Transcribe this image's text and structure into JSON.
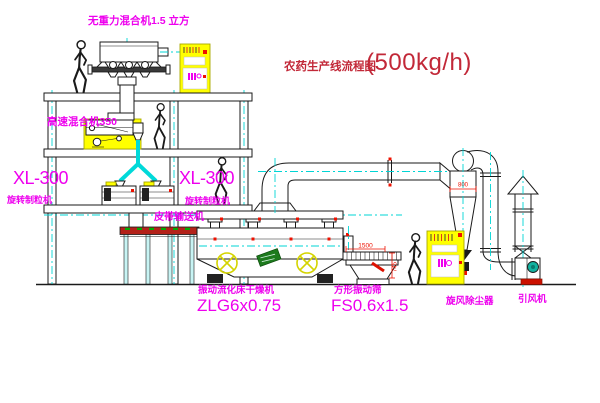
{
  "title": {
    "cn": "农药生产线流程图",
    "spec": "(500kg/h)"
  },
  "labels": {
    "mixer_top": "无重力混合机1.5 立方",
    "mixer_350": "高速混合机350",
    "xl300_left": "XL-300",
    "granulator_left": "旋转制粒机",
    "xl300_right": "XL-300",
    "granulator_right": "旋转制粒机",
    "belt_conveyor": "皮带输送机",
    "dryer_name": "振动流化床干燥机",
    "dryer_model": "ZLG6x0.75",
    "sieve_name": "方形振动筛",
    "sieve_model": "FS0.6x1.5",
    "cyclone": "旋风除尘器",
    "fan": "引风机"
  },
  "dims": {
    "sieve_length": "1500",
    "sieve_height": "745",
    "cyclone_diameter": "800"
  },
  "colors": {
    "line": "#1a1a1a",
    "centerline_cyan": "#00d5d5",
    "label_magenta": "#ee00ee",
    "title_red": "#c22838",
    "dimension_red": "#ee1100",
    "highlight_yellow": "#ffff00",
    "belt_red": "#b3221a",
    "motor_teal": "#12b2a0",
    "nameplate_green": "#1d7a1d"
  }
}
